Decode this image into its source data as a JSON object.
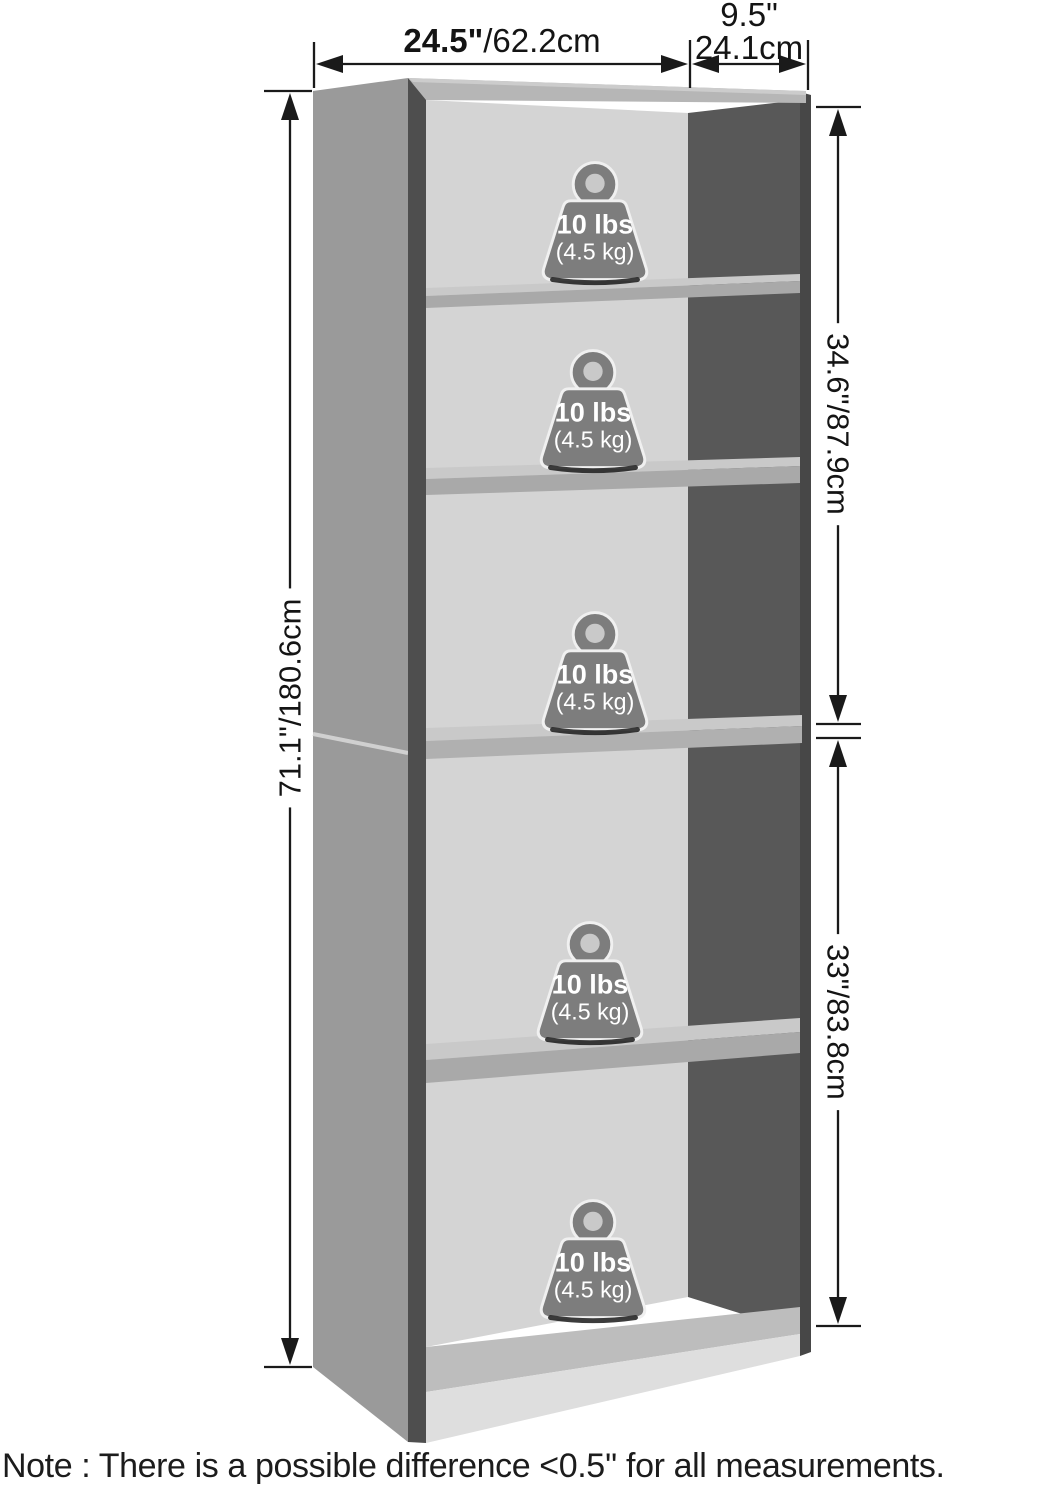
{
  "diagram": {
    "note": "Note : There is a possible difference <0.5'' for all measurements.",
    "dimensions": {
      "width": {
        "inches": "24.5\"",
        "cm": "/62.2cm"
      },
      "depth": {
        "inches": "9.5\"",
        "cm": "24.1cm"
      },
      "height": {
        "inches": "71.1\"",
        "cm": "/180.6cm"
      },
      "upper_section": {
        "inches": "34.6\"",
        "cm": "/87.9cm"
      },
      "lower_section": {
        "inches": "33\"",
        "cm": "/83.8cm"
      }
    },
    "weight": {
      "label": "10 lbs",
      "sublabel": "(4.5 kg)"
    }
  },
  "colors": {
    "line": "#1a1a1a",
    "side_panel": "#9a9a9a",
    "side_edge": "#4e4e4e",
    "back_panel": "#d4d4d4",
    "inner_side": "#585858",
    "outer_edge": "#474747",
    "top_panel": "#b6b6b6",
    "top_highlight": "#cccccc",
    "shelf_top": "#c9c9c9",
    "shelf_front": "#a9a9a9",
    "divider_front": "#b0b0b0",
    "base_top": "#bdbdbd",
    "kick_plate": "#dedede",
    "seam": "#d0d0d0",
    "weight_body": "#7d7d7d",
    "weight_hole": "#c9c9c9",
    "weight_outline": "#f0f0f0",
    "weight_text": "#ffffff"
  }
}
